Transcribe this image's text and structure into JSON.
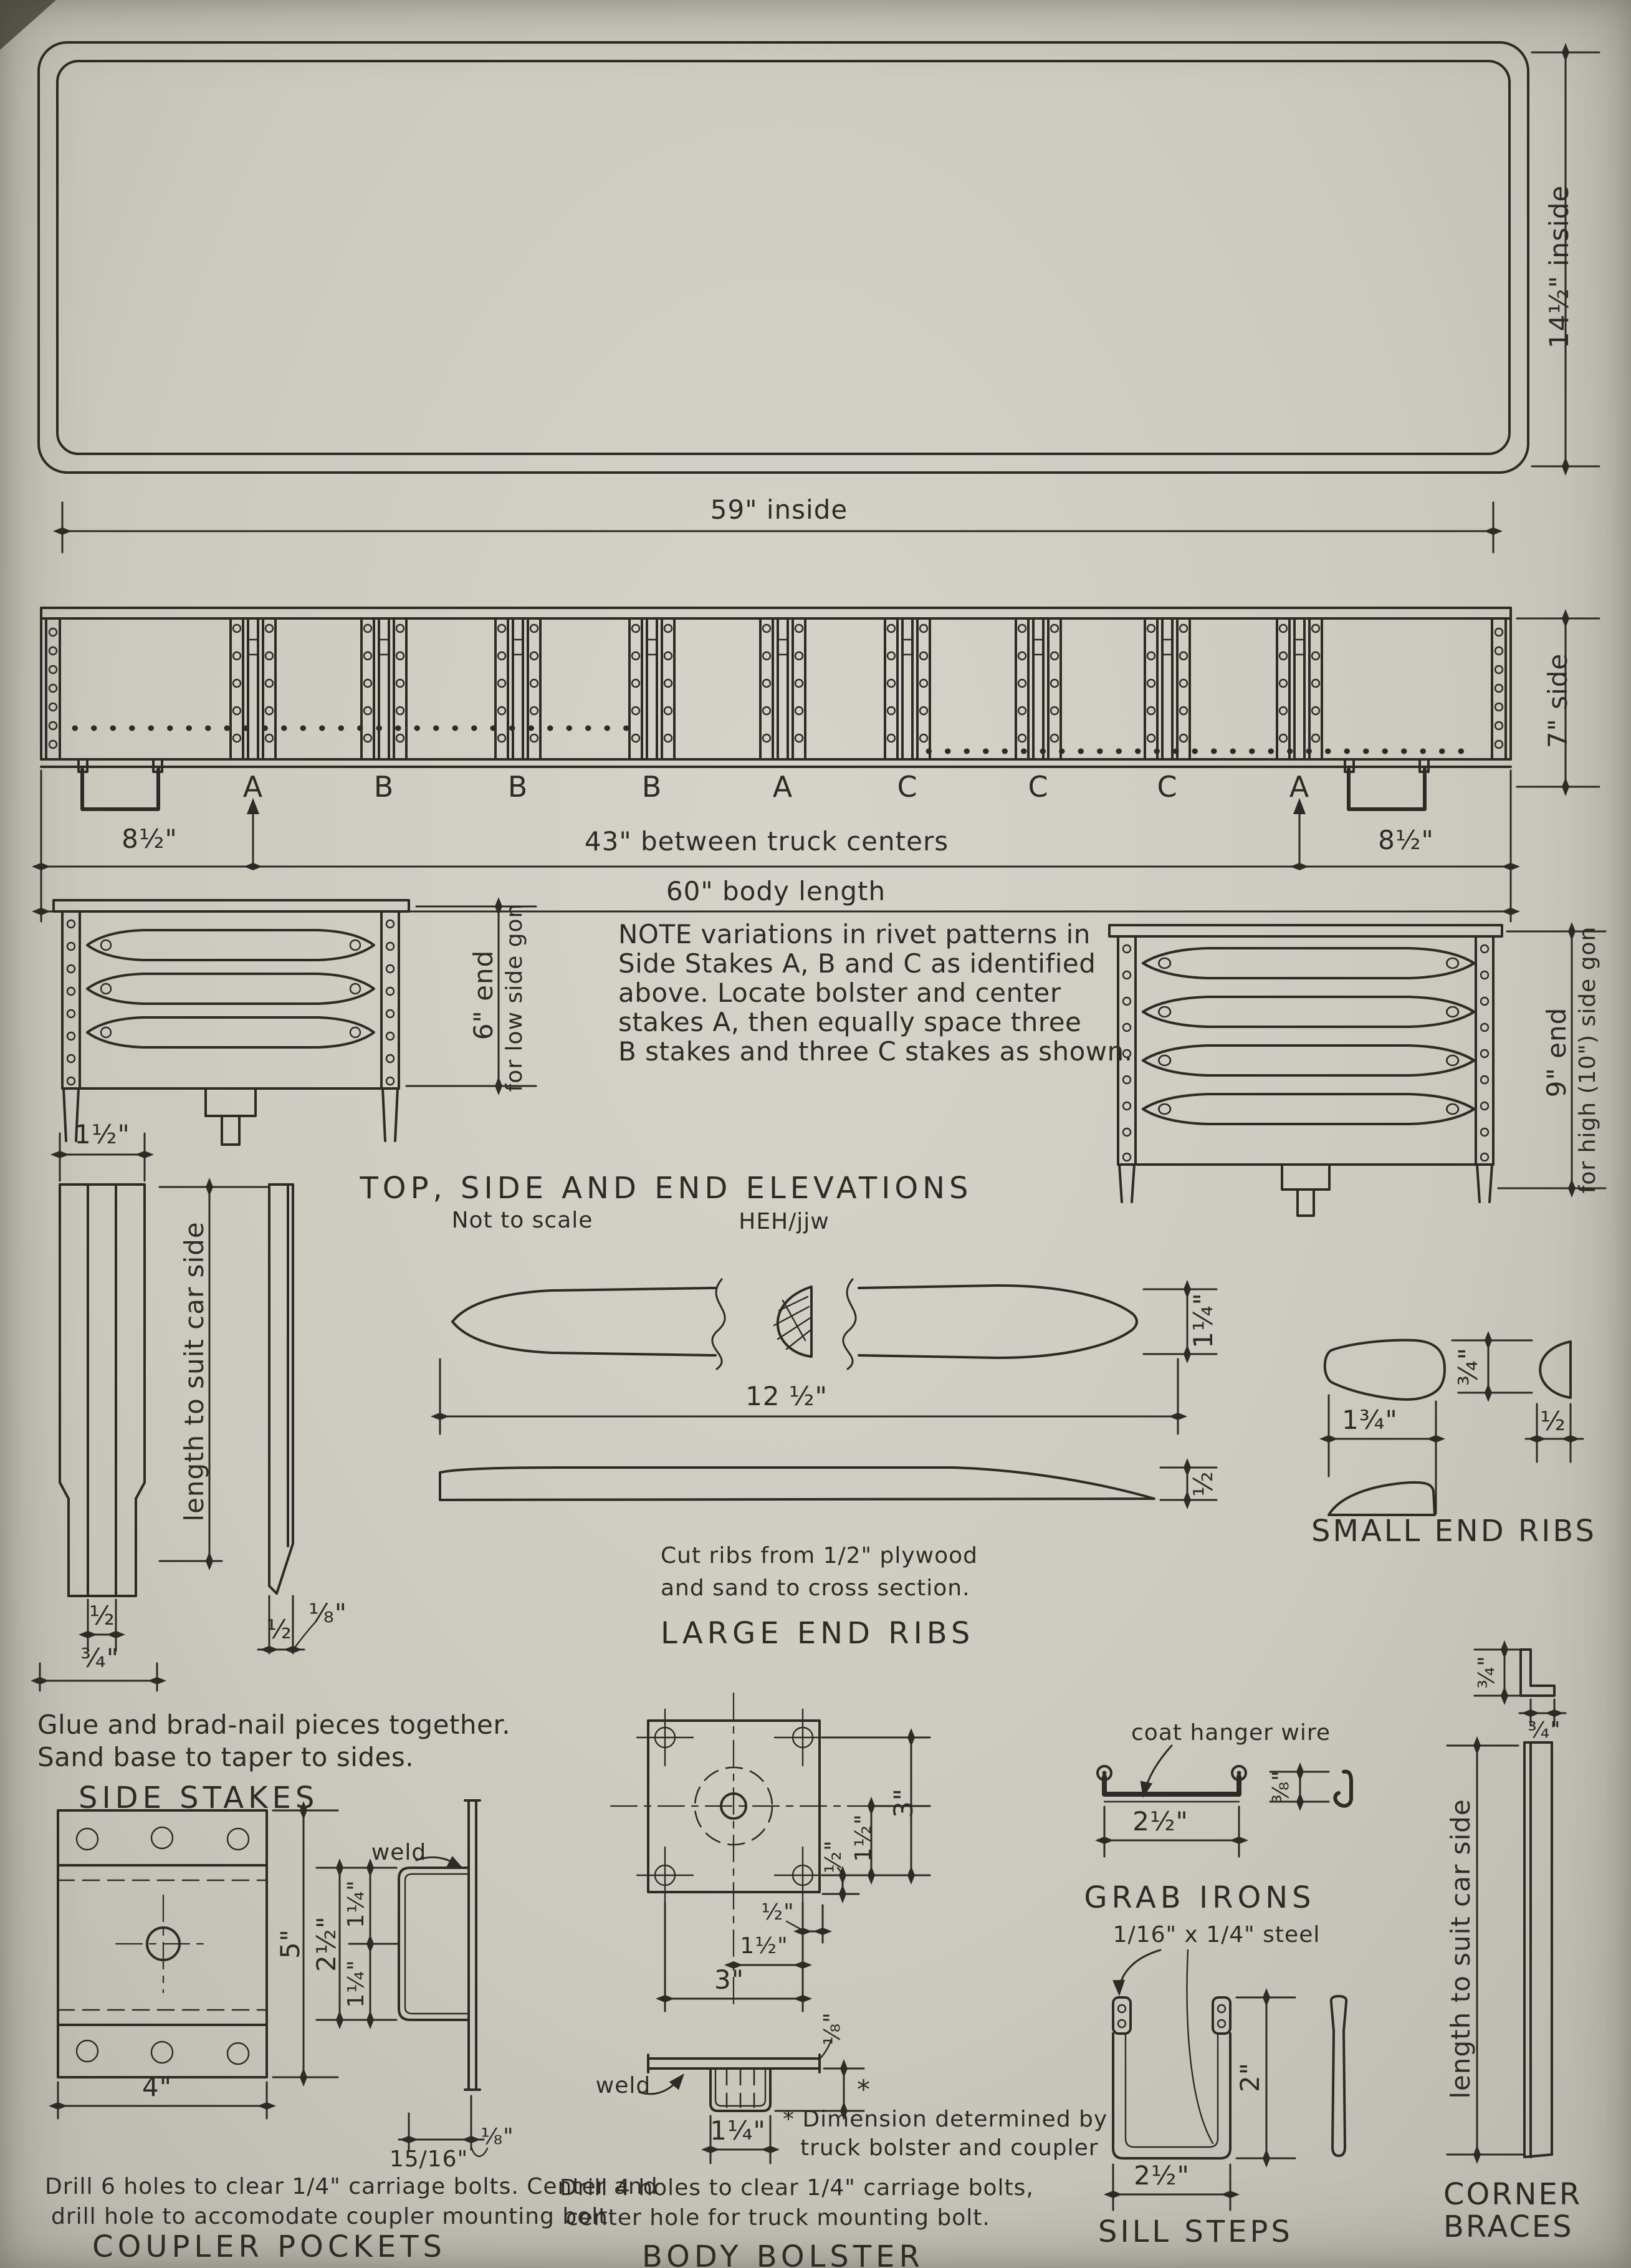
{
  "page": {
    "background": "#cccabf",
    "ink": "#2c2b27"
  },
  "top_view": {
    "dim_inside_length": "59\" inside",
    "dim_inside_width": "14½\" inside"
  },
  "side_view": {
    "stake_labels": [
      "A",
      "B",
      "B",
      "B",
      "A",
      "C",
      "C",
      "C",
      "A"
    ],
    "dim_overhang_left": "8½\"",
    "dim_truck_centers": "43\" between truck centers",
    "dim_body_length": "60\" body length",
    "dim_overhang_right": "8½\"",
    "dim_side_height": "7\" side"
  },
  "end_view_low": {
    "dim_line1": "6\" end",
    "dim_line2": "for low side gon"
  },
  "end_view_high": {
    "dim_line1": "9\" end",
    "dim_line2": "for high (10\") side gon"
  },
  "note": {
    "line1": "NOTE variations in rivet patterns in",
    "line2": "Side Stakes A, B and C as identified",
    "line3": "above.  Locate bolster and center",
    "line4": "stakes A, then equally space three",
    "line5": "B stakes and three C stakes as shown."
  },
  "title_block": {
    "title": "TOP, SIDE AND END ELEVATIONS",
    "scale_note": "Not to scale",
    "credit": "HEH/jjw"
  },
  "side_stakes": {
    "dim_width": "1½\"",
    "dim_length": "length to suit car side",
    "dim_half": "½",
    "dim_three_quarter": "¾\"",
    "dim_half_b": "½",
    "dim_eighth": "⅛\"",
    "note_line1": "Glue and brad-nail pieces together.",
    "note_line2": "Sand base to taper to sides.",
    "title": "SIDE STAKES"
  },
  "large_end_ribs": {
    "dim_length": "12 ½\"",
    "dim_height": "1¼\"",
    "dim_thickness": "½",
    "note_line1": "Cut ribs from 1/2\" plywood",
    "note_line2": "and sand to cross section.",
    "title": "LARGE END RIBS"
  },
  "small_end_ribs": {
    "dim_height": "¾\"",
    "dim_length": "1¾\"",
    "dim_thickness": "½",
    "title": "SMALL END RIBS"
  },
  "coupler_pockets": {
    "weld_label": "weld",
    "dim_height": "5\"",
    "dim_strap": "2½\"",
    "dim_upper": "1¼\"",
    "dim_lower": "1¼\"",
    "dim_width": "4\"",
    "dim_depth": "15/16\"",
    "dim_thickness": "⅛\"",
    "note_line1": "Drill 6 holes to clear 1/4\" carriage bolts. Center and",
    "note_line2": "drill hole to accomodate coupler mounting bolt",
    "title": "COUPLER POCKETS"
  },
  "body_bolster": {
    "dim_right_half": "½\"",
    "dim_right_one_half": "1½\"",
    "dim_right_three": "3\"",
    "dim_bottom_half": "½\"",
    "dim_bottom_one_half": "1½\"",
    "dim_bottom_three": "3\"",
    "dim_thickness": "⅛\"",
    "weld_label": "weld",
    "dim_pocket": "1¼\"",
    "star": "*",
    "star_note_line1": "* Dimension determined by",
    "star_note_line2": "truck bolster and coupler",
    "note_line1": "Drill 4 holes to clear 1/4\" carriage bolts,",
    "note_line2": "center hole for truck mounting bolt.",
    "title": "BODY BOLSTER"
  },
  "grab_irons": {
    "callout": "coat hanger wire",
    "dim_drop": "⅜\"",
    "dim_width": "2½\"",
    "title": "GRAB IRONS"
  },
  "sill_steps": {
    "callout": "1/16\" x 1/4\" steel",
    "dim_height": "2\"",
    "dim_width": "2½\"",
    "title": "SILL STEPS"
  },
  "corner_braces": {
    "dim_leg_a": "¾\"",
    "dim_leg_b": "¾\"",
    "dim_length": "length to suit car side",
    "title_line1": "CORNER",
    "title_line2": "BRACES"
  }
}
